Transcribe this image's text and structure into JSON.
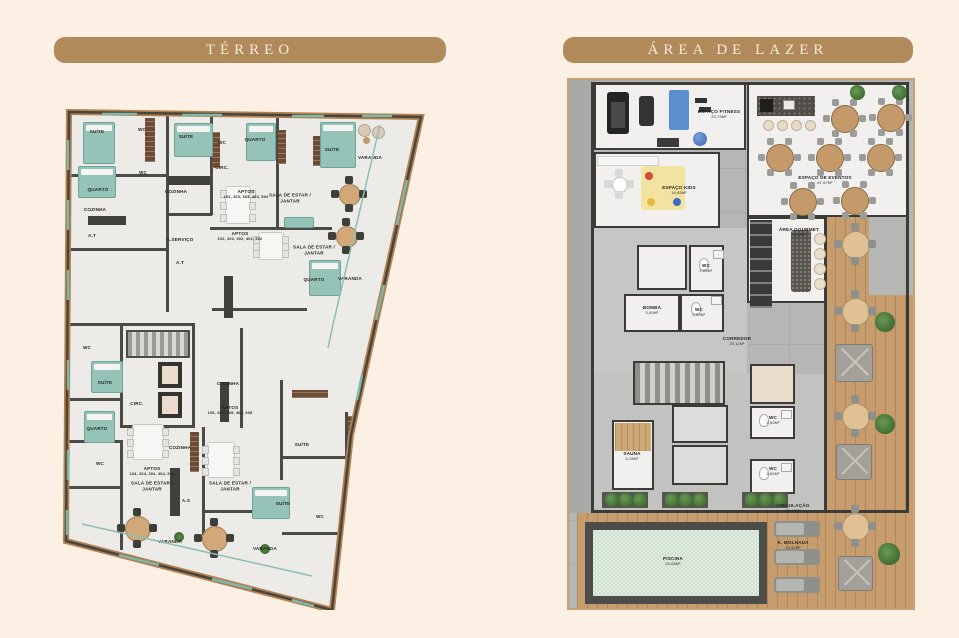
{
  "palette": {
    "background": "#fcefe4",
    "banner": "#b08a5a",
    "banner_text": "#f8ecd9",
    "accent_teal": "#96c3b8",
    "wood": "#c79d6e",
    "pool_water": "#cde0d0",
    "wall": "#3b3b37"
  },
  "terreo": {
    "title": "TÉRREO",
    "labels": [
      {
        "t": "SUÍTE"
      },
      {
        "t": "WC"
      },
      {
        "t": "SUÍTE"
      },
      {
        "t": "WC"
      },
      {
        "t": "QUARTO"
      },
      {
        "t": "SUÍTE"
      },
      {
        "t": "VARANDA"
      },
      {
        "t": "QUARTO"
      },
      {
        "t": "WC"
      },
      {
        "t": "CIRC."
      },
      {
        "t": "COZINHA"
      },
      {
        "t": "APTOS",
        "s": "103, 203, 303, 403, 503"
      },
      {
        "t": "SALA DE ESTAR / JANTAR"
      },
      {
        "t": "A.T"
      },
      {
        "t": "A.SERVIÇO"
      },
      {
        "t": "A.T"
      },
      {
        "t": "COZINHA"
      },
      {
        "t": "APTOS",
        "s": "102, 202, 302, 402, 502"
      },
      {
        "t": "SALA DE ESTAR / JANTAR"
      },
      {
        "t": "QUARTO"
      },
      {
        "t": "VARANDA"
      },
      {
        "t": "WC"
      },
      {
        "t": "CIRC."
      },
      {
        "t": "SUÍTE"
      },
      {
        "t": "QUARTO"
      },
      {
        "t": "WC"
      },
      {
        "t": "COZINHA"
      },
      {
        "t": "APTOS",
        "s": "105, 205, 305, 405, 505"
      },
      {
        "t": "COZINHA"
      },
      {
        "t": "APTOS",
        "s": "104, 204, 304, 404, 504"
      },
      {
        "t": "SALA DE ESTAR / JANTAR"
      },
      {
        "t": "A.S"
      },
      {
        "t": "SALA DE ESTAR / JANTAR"
      },
      {
        "t": "SUÍTE"
      },
      {
        "t": "SUÍTE"
      },
      {
        "t": "WC"
      },
      {
        "t": "VARANDA"
      },
      {
        "t": "VARANDA"
      }
    ]
  },
  "lazer": {
    "title": "ÁREA DE LAZER",
    "rooms": [
      {
        "label": "ESPAÇO FITNESS",
        "area": "23,73M²"
      },
      {
        "label": "ESPAÇO KIDS",
        "area": "16,85M²"
      },
      {
        "label": "ESPAÇO DE EVENTOS",
        "area": "67,67M²"
      },
      {
        "label": "ÁREA GOURMET",
        "area": "15,45M²"
      },
      {
        "label": "BOMBA",
        "area": "3,00M²"
      },
      {
        "label": "WC",
        "area": "2,05M²"
      },
      {
        "label": "WC",
        "area": "2,90M²"
      },
      {
        "label": "CORREDOR",
        "area": "20,11M²"
      },
      {
        "label": "SAUNA",
        "area": "5,15M²"
      },
      {
        "label": "WC",
        "area": "2,50M²"
      },
      {
        "label": "WC",
        "area": "2,60M²"
      },
      {
        "label": "CIRCULAÇÃO",
        "area": "27,46M²"
      },
      {
        "label": "Á. MOLHADA",
        "area": "13,52M²"
      },
      {
        "label": "PISCINA",
        "area": "24,06M²"
      }
    ]
  }
}
